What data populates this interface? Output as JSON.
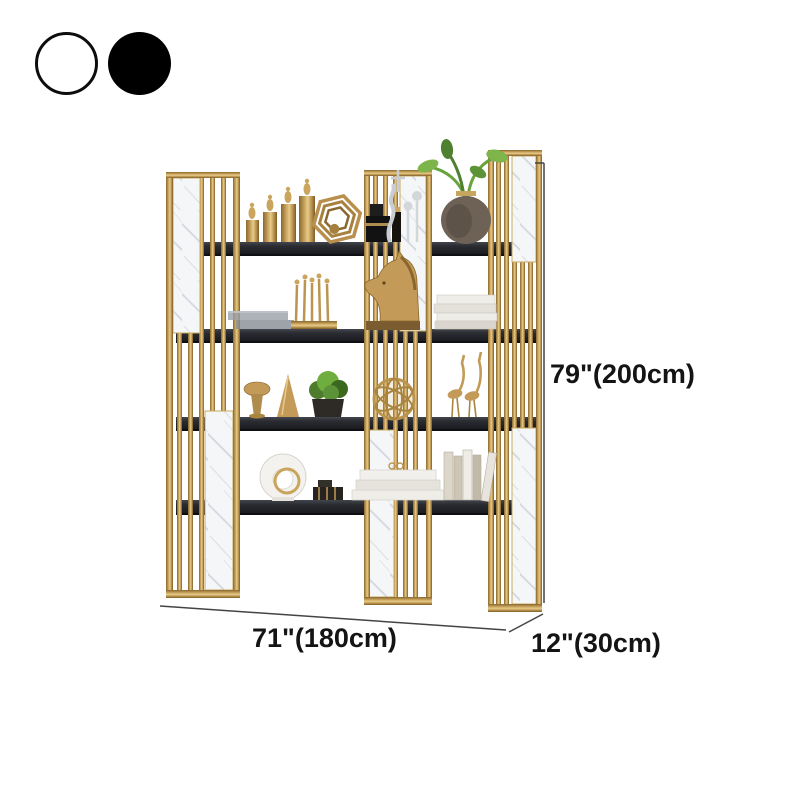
{
  "product": {
    "color_options": [
      {
        "label": "White",
        "hex": "#FFFFFF"
      },
      {
        "label": "Black",
        "hex": "#000000"
      }
    ],
    "dimensions": {
      "height_label": "79\"(200cm)",
      "width_label": "71\"(180cm)",
      "depth_label": "12\"(30cm)"
    },
    "palette": {
      "gold": "#B5914F",
      "marble_white": "#F5F6F8",
      "shelf_black": "#212327",
      "leaf_green": "#6FAE3E",
      "dimension_line": "#444444"
    }
  }
}
